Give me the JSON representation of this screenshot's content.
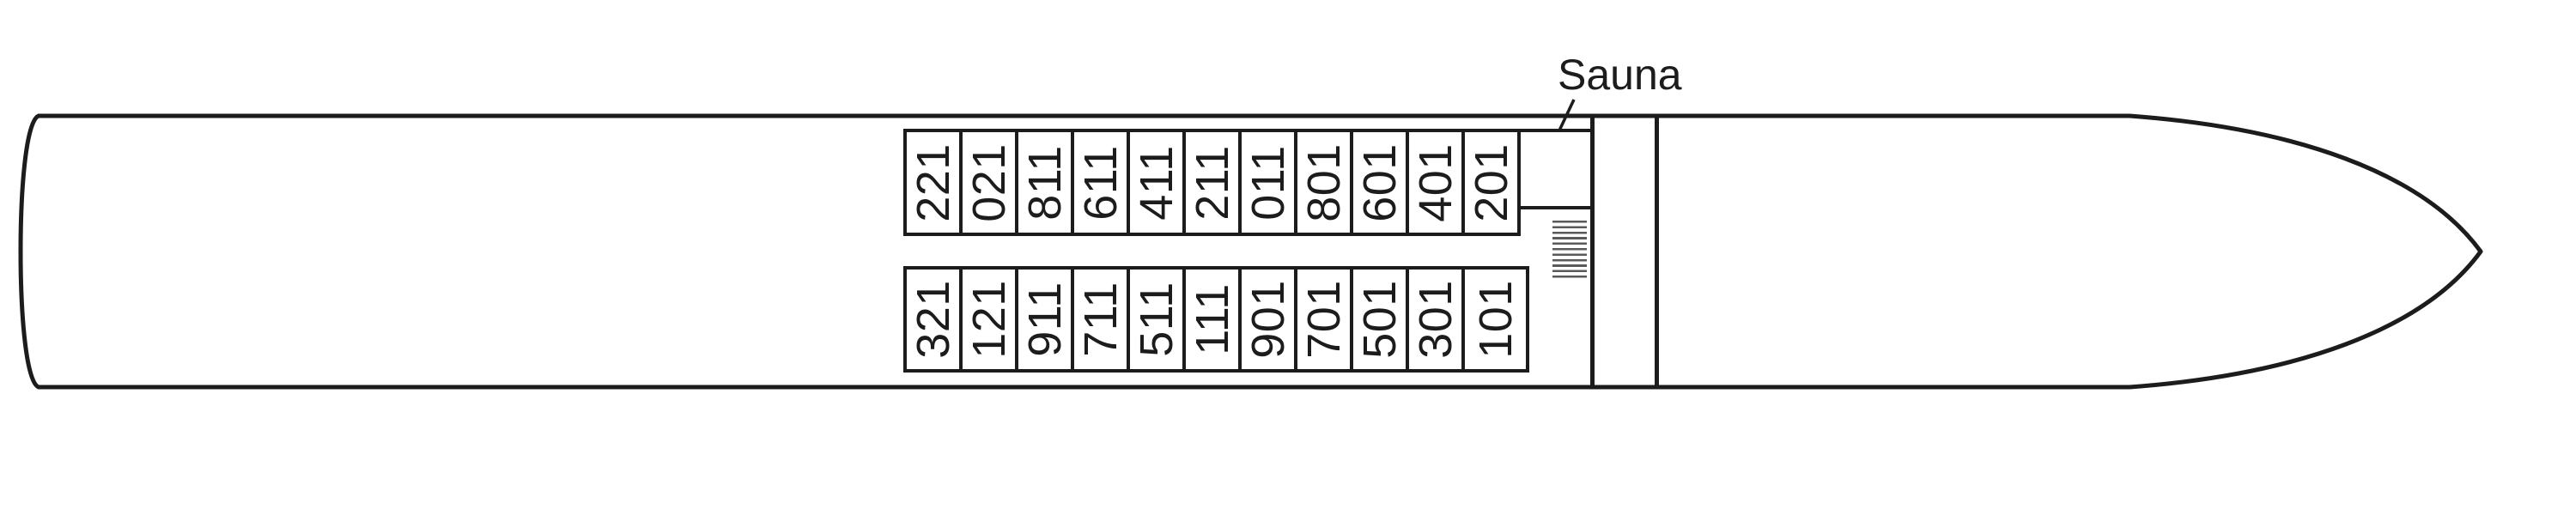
{
  "diagram": {
    "sauna_label": "Sauna",
    "top_row": {
      "cabins": [
        "122",
        "120",
        "118",
        "116",
        "114",
        "112",
        "110",
        "108",
        "106",
        "104",
        "102"
      ]
    },
    "bottom_row": {
      "cabins": [
        "123",
        "121",
        "119",
        "117",
        "115",
        "111",
        "109",
        "107",
        "105",
        "103",
        "101"
      ]
    },
    "stairs_icon": "stairs-hatch",
    "colors": {
      "line": "#1c1c1c",
      "background": "#ffffff",
      "stairs_hatch": "#5a5a5a"
    }
  }
}
